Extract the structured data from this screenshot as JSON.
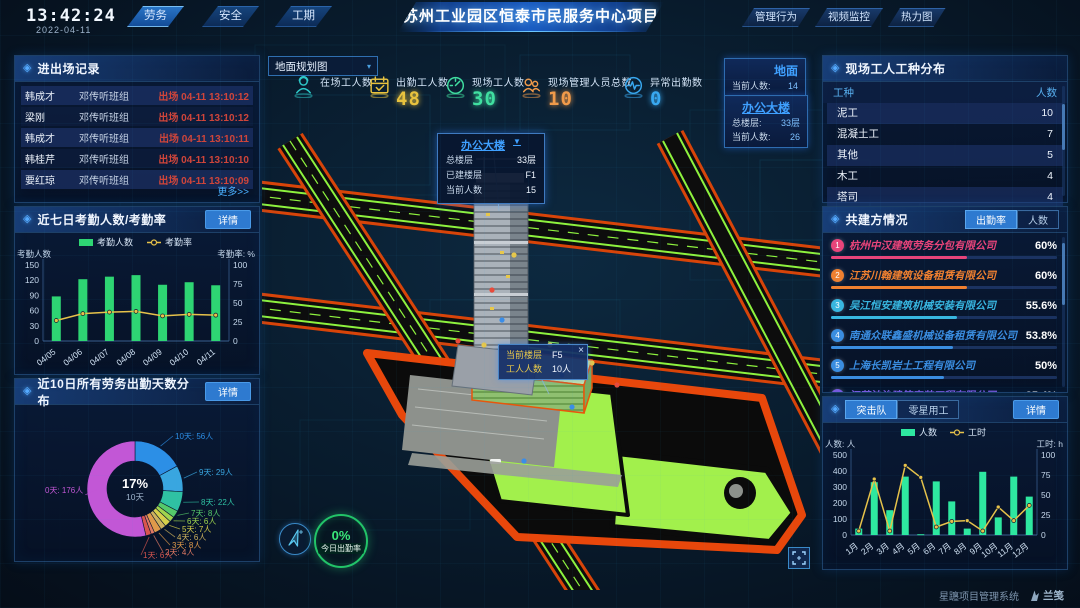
{
  "topbar": {
    "time": "13:42:24",
    "date": "2022-04-11",
    "left_tabs": [
      {
        "label": "劳务",
        "active": true
      },
      {
        "label": "安全",
        "active": false
      },
      {
        "label": "工期",
        "active": false
      }
    ],
    "title": "苏州工业园区恒泰市民服务中心项目",
    "right_tabs": [
      {
        "label": "管理行为"
      },
      {
        "label": "视频监控"
      },
      {
        "label": "热力图"
      }
    ]
  },
  "entry_exit_panel": {
    "title": "进出场记录",
    "more_label": "更多>>",
    "rows": [
      {
        "name": "韩成才",
        "group": "邓传听班组",
        "event": "出场 04-11 13:10:12"
      },
      {
        "name": "梁刚",
        "group": "邓传听班组",
        "event": "出场 04-11 13:10:12"
      },
      {
        "name": "韩成才",
        "group": "邓传听班组",
        "event": "出场 04-11 13:10:11"
      },
      {
        "name": "韩桂芹",
        "group": "邓传听班组",
        "event": "出场 04-11 13:10:10"
      },
      {
        "name": "要红琼",
        "group": "邓传听班组",
        "event": "出场 04-11 13:10:09"
      }
    ]
  },
  "attendance_panel": {
    "title": "近七日考勤人数/考勤率",
    "detail_label": "详情"
  },
  "distribution_panel": {
    "title": "近10日所有劳务出勤天数分布",
    "detail_label": "详情"
  },
  "map": {
    "layer_select": "地面规划图",
    "layer_caret": "▾",
    "stats": [
      {
        "icon": "worker-icon",
        "label": "在场工人数",
        "value": "",
        "color": "#2ec8c8"
      },
      {
        "icon": "calendar-check-icon",
        "label": "出勤工人数",
        "value": "48",
        "color": "#e8c23e"
      },
      {
        "icon": "gauge-icon",
        "label": "现场工人数",
        "value": "30",
        "color": "#40dfa0"
      },
      {
        "icon": "people-icon",
        "label": "现场管理人员总数",
        "value": "10",
        "color": "#f09a4a"
      },
      {
        "icon": "pulse-icon",
        "label": "异常出勤数",
        "value": "0",
        "color": "#38a8f0"
      }
    ],
    "building_popup": {
      "title": "办公大楼",
      "caret": "▼",
      "rows": [
        [
          "总楼层",
          "33层"
        ],
        [
          "已建楼层",
          "F1"
        ],
        [
          "当前人数",
          "15"
        ]
      ]
    },
    "floor_tooltip": {
      "close_label": "×",
      "rows": [
        [
          "当前楼层",
          "F5"
        ],
        [
          "工人人数",
          "10人"
        ]
      ]
    },
    "ground_card": {
      "title": "地面",
      "rows": [
        [
          "当前人数:",
          "14"
        ]
      ]
    },
    "tower_card": {
      "title": "办公大楼",
      "rows": [
        [
          "总楼层:",
          "33层"
        ],
        [
          "当前人数:",
          "26"
        ]
      ]
    },
    "attendance_badge": {
      "value": "0%",
      "label": "今日出勤率"
    },
    "icons": {
      "compass": "compass-icon",
      "fullscreen": "fullscreen-icon",
      "close": "close-icon"
    }
  },
  "trade_panel": {
    "title": "现场工人工种分布",
    "headers": [
      "工种",
      "人数"
    ],
    "rows": [
      [
        "泥工",
        "10"
      ],
      [
        "混凝土工",
        "7"
      ],
      [
        "其他",
        "5"
      ],
      [
        "木工",
        "4"
      ],
      [
        "塔司",
        "4"
      ]
    ]
  },
  "partners_panel": {
    "title": "共建方情况",
    "tabs": [
      {
        "label": "出勤率",
        "active": true
      },
      {
        "label": "人数",
        "active": false
      }
    ],
    "rows": [
      {
        "rank": "1",
        "name": "杭州中汉建筑劳务分包有限公司",
        "value": "60%",
        "pct": 60,
        "color": "#e8447a"
      },
      {
        "rank": "2",
        "name": "江苏川翰建筑设备租赁有限公司",
        "value": "60%",
        "pct": 60,
        "color": "#f08030"
      },
      {
        "rank": "3",
        "name": "吴江恒安建筑机械安装有限公司",
        "value": "55.6%",
        "pct": 55.6,
        "color": "#38b6e0"
      },
      {
        "rank": "4",
        "name": "南通众联鑫盛机械设备租赁有限公司",
        "value": "53.8%",
        "pct": 53.8,
        "color": "#3a8de0"
      },
      {
        "rank": "5",
        "name": "上海长凯岩土工程有限公司",
        "value": "50%",
        "pct": 50,
        "color": "#3a8de0"
      },
      {
        "rank": "6",
        "name": "江苏法治建筑安装工程有限公司",
        "value": "35.4%",
        "pct": 35.4,
        "color": "#7a5ae0"
      }
    ]
  },
  "squad_panel": {
    "tabs": [
      {
        "label": "突击队",
        "active": true
      },
      {
        "label": "零星用工",
        "active": false
      }
    ],
    "detail_label": "详情"
  },
  "footer": {
    "brand": "星躔项目管理系统",
    "logo": "兰笺"
  },
  "chart_data": [
    {
      "id": "attendance-7d",
      "type": "bar+line",
      "title": "近七日考勤人数/考勤率",
      "categories": [
        "04/05",
        "04/06",
        "04/07",
        "04/08",
        "04/09",
        "04/10",
        "04/11"
      ],
      "series": [
        {
          "name": "考勤人数",
          "type": "bar",
          "axis": "left",
          "color": "#2ed573",
          "values": [
            88,
            122,
            127,
            130,
            111,
            116,
            110
          ]
        },
        {
          "name": "考勤率",
          "type": "line",
          "axis": "right",
          "color": "#e6c24a",
          "values": [
            27,
            36,
            38,
            39,
            33,
            35,
            34
          ]
        }
      ],
      "left_axis": {
        "label": "考勤人数",
        "min": 0,
        "max": 150,
        "step": 30
      },
      "right_axis": {
        "label": "考勤率: %",
        "min": 0,
        "max": 100,
        "step": 25
      },
      "grid": false,
      "legend_position": "top"
    },
    {
      "id": "days-distribution",
      "type": "pie",
      "title": "近10日所有劳务出勤天数分布",
      "center": {
        "pct": "17%",
        "label": "10天"
      },
      "slices": [
        {
          "label": "10天: 56人",
          "value": 56,
          "color": "#2c8fe6"
        },
        {
          "label": "9天: 29人",
          "value": 29,
          "color": "#39a6e0"
        },
        {
          "label": "8天: 22人",
          "value": 22,
          "color": "#2fc1a3"
        },
        {
          "label": "7天: 8人",
          "value": 8,
          "color": "#55c96a"
        },
        {
          "label": "6天: 6人",
          "value": 6,
          "color": "#9fd44e"
        },
        {
          "label": "5天: 7人",
          "value": 7,
          "color": "#d6cf4a"
        },
        {
          "label": "4天: 6人",
          "value": 6,
          "color": "#cdb25e"
        },
        {
          "label": "3天: 8人",
          "value": 8,
          "color": "#e09a4a"
        },
        {
          "label": "2天: 4人",
          "value": 4,
          "color": "#e07a64"
        },
        {
          "label": "1天: 6人",
          "value": 6,
          "color": "#d8554f"
        },
        {
          "label": "0天: 176人",
          "value": 176,
          "color": "#c257d6"
        }
      ]
    },
    {
      "id": "squad-monthly",
      "type": "bar+line",
      "title": "突击队",
      "categories": [
        "1月",
        "2月",
        "3月",
        "4月",
        "5月",
        "6月",
        "7月",
        "8月",
        "9月",
        "10月",
        "11月",
        "12月"
      ],
      "series": [
        {
          "name": "人数",
          "type": "bar",
          "axis": "left",
          "color": "#2ee8a0",
          "values": [
            40,
            330,
            155,
            365,
            5,
            335,
            210,
            40,
            395,
            110,
            365,
            240
          ]
        },
        {
          "name": "工时",
          "type": "line",
          "axis": "right",
          "color": "#e6c24a",
          "values": [
            5,
            70,
            5,
            87,
            72,
            10,
            17,
            18,
            5,
            35,
            18,
            37
          ]
        }
      ],
      "left_axis": {
        "label": "人数: 人",
        "min": 0,
        "max": 500,
        "step": 100
      },
      "right_axis": {
        "label": "工时: h",
        "min": 0,
        "max": 100,
        "step": 25
      },
      "grid": false,
      "legend_position": "top"
    }
  ]
}
